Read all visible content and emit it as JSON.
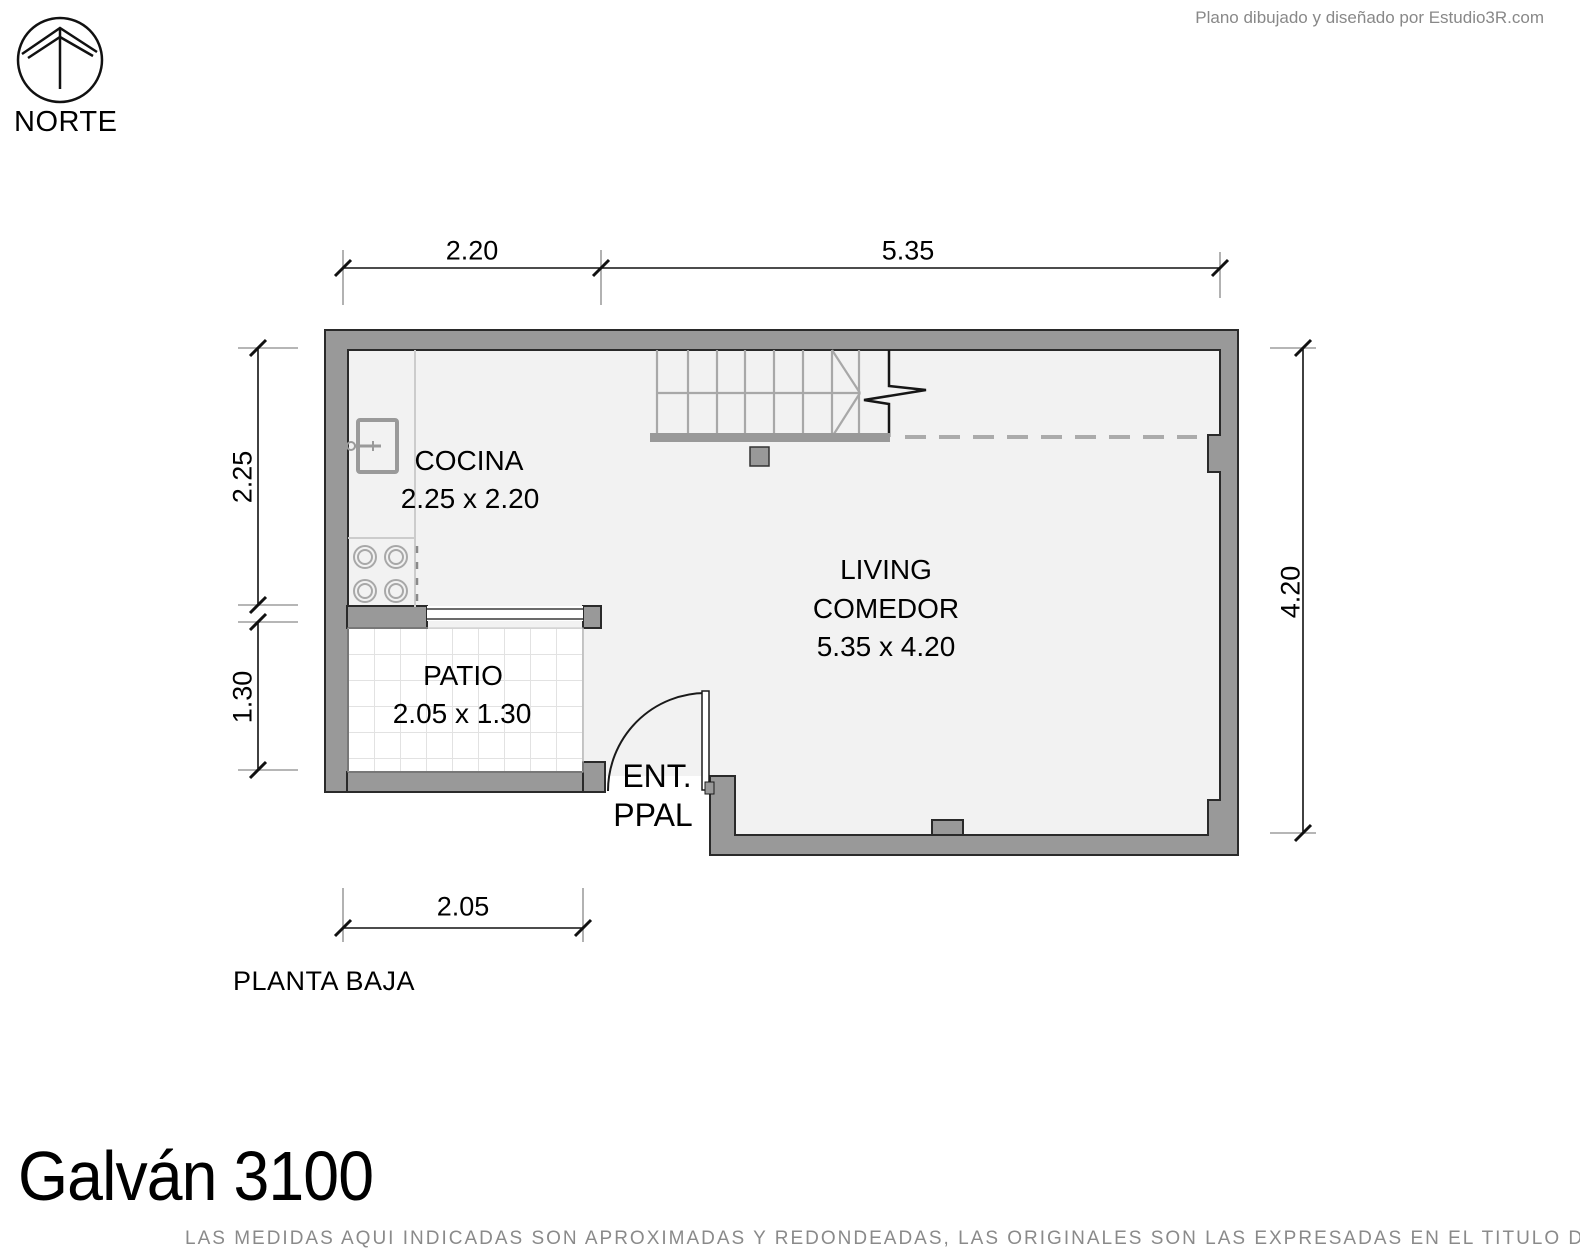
{
  "credit": "Plano dibujado y diseñado por Estudio3R.com",
  "compass_label": "NORTE",
  "floor_label": "PLANTA BAJA",
  "title": "Galván 3100",
  "disclaimer": "LAS MEDIDAS AQUI INDICADAS SON APROXIMADAS Y REDONDEADAS, LAS ORIGINALES SON LAS EXPRESADAS EN EL TITULO DE PROPIEDAD",
  "dims": {
    "top_left": "2.20",
    "top_right": "5.35",
    "left_upper": "2.25",
    "left_lower": "1.30",
    "right_side": "4.20",
    "bottom": "2.05"
  },
  "rooms": {
    "cocina": {
      "name": "COCINA",
      "size": "2.25 x 2.20"
    },
    "living": {
      "line1": "LIVING",
      "line2": "COMEDOR",
      "size": "5.35 x 4.20"
    },
    "patio": {
      "name": "PATIO",
      "size": "2.05 x 1.30"
    },
    "entrance": {
      "line1": "ENT.",
      "line2": "PPAL"
    }
  },
  "colors": {
    "wall_fill": "#999999",
    "wall_outline": "#2a2a2a",
    "room_fill": "#f2f2f2",
    "stair_line": "#a8a8a8",
    "muted_text": "#8a8a8a"
  }
}
